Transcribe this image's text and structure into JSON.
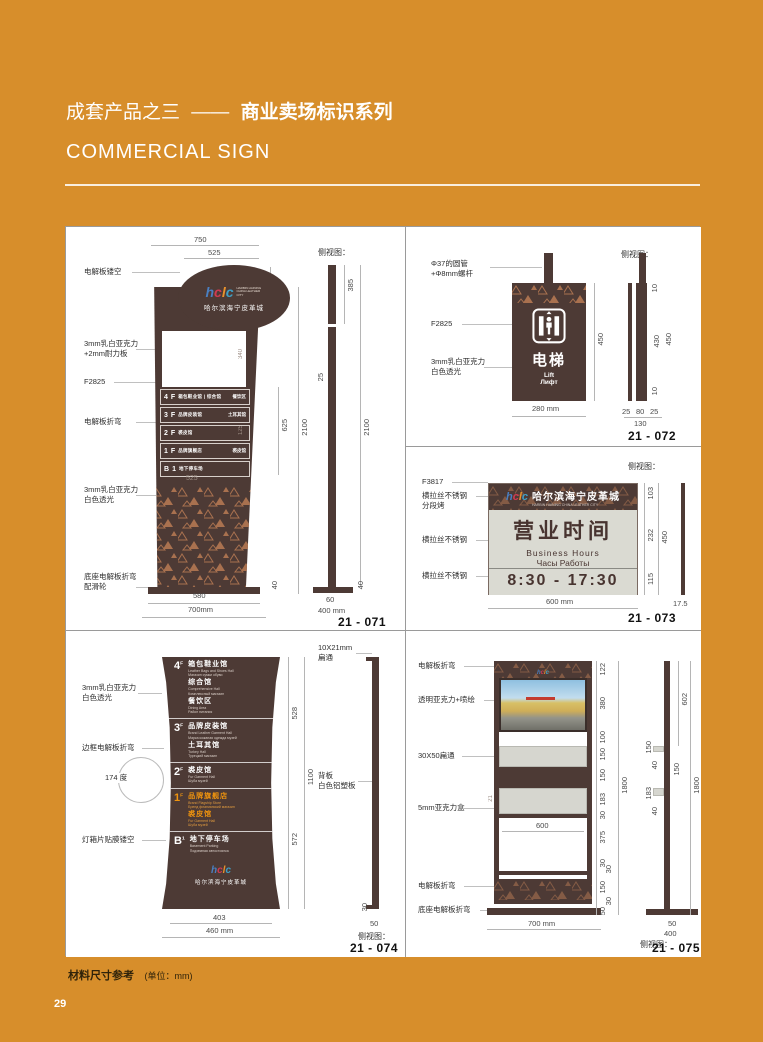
{
  "page": {
    "bg_color": "#d78e2b",
    "title_prefix": "成套产品之三",
    "title_dash": "——",
    "title_main": "商业卖场标识系列",
    "subtitle": "COMMERCIAL SIGN",
    "footer_title": "材料尺寸参考",
    "footer_unit": "(单位：mm)",
    "page_number": "29"
  },
  "brand": {
    "logo_letters": [
      "h",
      "c",
      "l",
      "c"
    ],
    "logo_tagline": "HARBIN HAINING CHINA LEATHER CITY",
    "name_cn": "哈尔滨海宁皮革城"
  },
  "side_view_label": "侧视图：",
  "p071": {
    "code": "21 - 071",
    "labels": {
      "l1": "电解板镂空",
      "l2": "3mm乳白亚克力\n+2mm耐力板",
      "l3": "F2825",
      "l4": "电解板折弯",
      "l5": "3mm乳白亚克力\n白色透光",
      "l6": "底座电解板折弯\n配滑轮"
    },
    "rows": [
      {
        "f": "4",
        "sup": "F",
        "t": "箱包鞋业馆 | 综合馆",
        "r": "餐饮区"
      },
      {
        "f": "3",
        "sup": "F",
        "t": "品牌皮装馆",
        "r": "土耳其馆"
      },
      {
        "f": "2",
        "sup": "F",
        "t": "裘皮馆",
        "r": ""
      },
      {
        "f": "1",
        "sup": "F",
        "t": "品牌旗舰店",
        "r": "裘皮馆"
      },
      {
        "f": "B",
        "sup": "1",
        "t": "地下停车场",
        "r": ""
      }
    ],
    "dims": {
      "top_w": "750",
      "inner_w": "525",
      "logo_h": "385",
      "list_h": "625",
      "total_h": "2100",
      "base_t": "40",
      "base_w": "580",
      "overall_w": "700mm",
      "ghost_w": "525",
      "ghost_h1": "340",
      "ghost_h2": "125",
      "side_logo_h": "385",
      "side_t": "25",
      "side_total_h": "2100",
      "side_base_t": "40",
      "side_base_w": "60",
      "side_overall_w": "400 mm"
    }
  },
  "p072": {
    "code": "21 - 072",
    "labels": {
      "l1": "Φ37的圆管\n+Φ8mm螺杆",
      "l2": "F2825",
      "l3": "3mm乳白亚克力\n白色透光"
    },
    "sign": {
      "cn": "电梯",
      "en": "Lift",
      "ru": "Лифт"
    },
    "dims": {
      "h": "450",
      "w": "280 mm",
      "side_t1": "10",
      "side_h": "430",
      "side_total": "450",
      "side_t2": "10",
      "side_b1": "25",
      "side_b2": "80",
      "side_b3": "25",
      "side_total_w": "130"
    }
  },
  "p073": {
    "code": "21 - 073",
    "labels": {
      "l1": "F3817",
      "l2": "横拉丝不锈钢\n分段烤",
      "l3": "横拉丝不锈钢",
      "l4": "横拉丝不锈钢"
    },
    "sign": {
      "title": "营业时间",
      "en": "Business Hours",
      "ru": "Часы Работы",
      "hours": "8:30 - 17:30"
    },
    "dims": {
      "h1": "103",
      "h2": "232",
      "h3": "115",
      "total_h": "450",
      "w": "600 mm",
      "side_t": "17.5"
    }
  },
  "p074": {
    "code": "21 - 074",
    "labels": {
      "l1": "3mm乳白亚克力\n白色透光",
      "l2": "边框电解板折弯",
      "l3": "174 度",
      "l4": "灯箱片贴膜镂空",
      "r1": "10X21mm\n扁通",
      "r2": "背板\n白色铝塑板"
    },
    "rows": [
      {
        "floor": "4",
        "sup": "F",
        "venues": [
          {
            "cn": "箱包鞋业馆",
            "en": "Leather Bags and Shoes Hall",
            "ru": "Магазин сумки обуви"
          },
          {
            "cn": "综合馆",
            "en": "Comprehensive Hall",
            "ru": "Комплексный магазин"
          },
          {
            "cn": "餐饮区",
            "en": "Dining Area",
            "ru": "Район питания"
          }
        ]
      },
      {
        "floor": "3",
        "sup": "F",
        "venues": [
          {
            "cn": "品牌皮装馆",
            "en": "Brand Leather Garment Hall",
            "ru": "Марка кожаная одежда музей"
          },
          {
            "cn": "土耳其馆",
            "en": "Turkey Hall",
            "ru": "Турецкий магазин"
          }
        ]
      },
      {
        "floor": "2",
        "sup": "F",
        "venues": [
          {
            "cn": "裘皮馆",
            "en": "Fur Garment Hall",
            "ru": "Шуба музей"
          }
        ]
      },
      {
        "floor": "1",
        "sup": "F",
        "venues": [
          {
            "cn": "品牌旗舰店",
            "en": "Brand Flagship Store",
            "ru": "Бренд флагманский магазин"
          },
          {
            "cn": "裘皮馆",
            "en": "Fur Garment Hall",
            "ru": "Шуба музей"
          }
        ]
      },
      {
        "floor": "B",
        "sup": "1",
        "venues": [
          {
            "cn": "地下停车场",
            "en": "Basement Parking",
            "ru": "Подземная автостоянка"
          }
        ]
      }
    ],
    "dims": {
      "top_h": "528",
      "total_h": "1100",
      "bot_h": "572",
      "inner_w": "403",
      "w": "460 mm",
      "side_b": "30",
      "side_w": "50"
    }
  },
  "p075": {
    "code": "21 - 075",
    "labels": {
      "l1": "电解板折弯",
      "l2": "透明亚克力+喷绘",
      "l3": "30X50扁通",
      "l4": "5mm亚克力盒",
      "l5": "电解板折弯",
      "l6": "底座电解板折弯"
    },
    "dims": {
      "d1": "122",
      "d2": "380",
      "d3": "100",
      "d4": "150",
      "d5": "150",
      "d6": "183",
      "d7": "30",
      "d8": "375",
      "d9": "30",
      "d10": "30",
      "d11": "150",
      "d12": "30",
      "d13": "50",
      "total_h": "1800",
      "inner_w": "600",
      "w": "700 mm",
      "tray_t": "21",
      "s1": "602",
      "s2": "150",
      "s3": "40",
      "s4": "150",
      "s5": "183",
      "s6": "40",
      "side_total": "1800",
      "side_b1": "50",
      "side_b2": "400"
    }
  }
}
